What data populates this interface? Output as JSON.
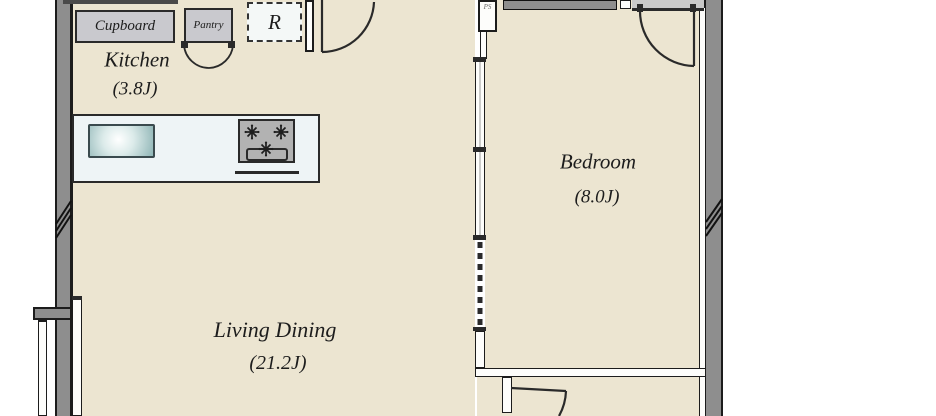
{
  "plan_title": "Apartment floor plan",
  "rooms": {
    "kitchen": {
      "name": "Kitchen",
      "size": "(3.8J)"
    },
    "bedroom": {
      "name": "Bedroom",
      "size": "(8.0J)"
    },
    "living_dining": {
      "name": "Living Dining",
      "size": "(21.2J)"
    }
  },
  "fixtures": {
    "cupboard": "Cupboard",
    "pantry": "Pantry",
    "refrigerator": "R",
    "pipe_shaft": "PS"
  },
  "colors": {
    "floor_beige": "#ece5d1",
    "outer_wall_gray": "#8e8e8e",
    "cabinet_gray": "#c9c9ce",
    "counter_white": "#eef4f6",
    "sink_teal": "#8fb5b6",
    "stove_gray": "#b2b2b2",
    "corridor_gray": "#c9c9c9",
    "line_dark": "#2a2a2a"
  }
}
